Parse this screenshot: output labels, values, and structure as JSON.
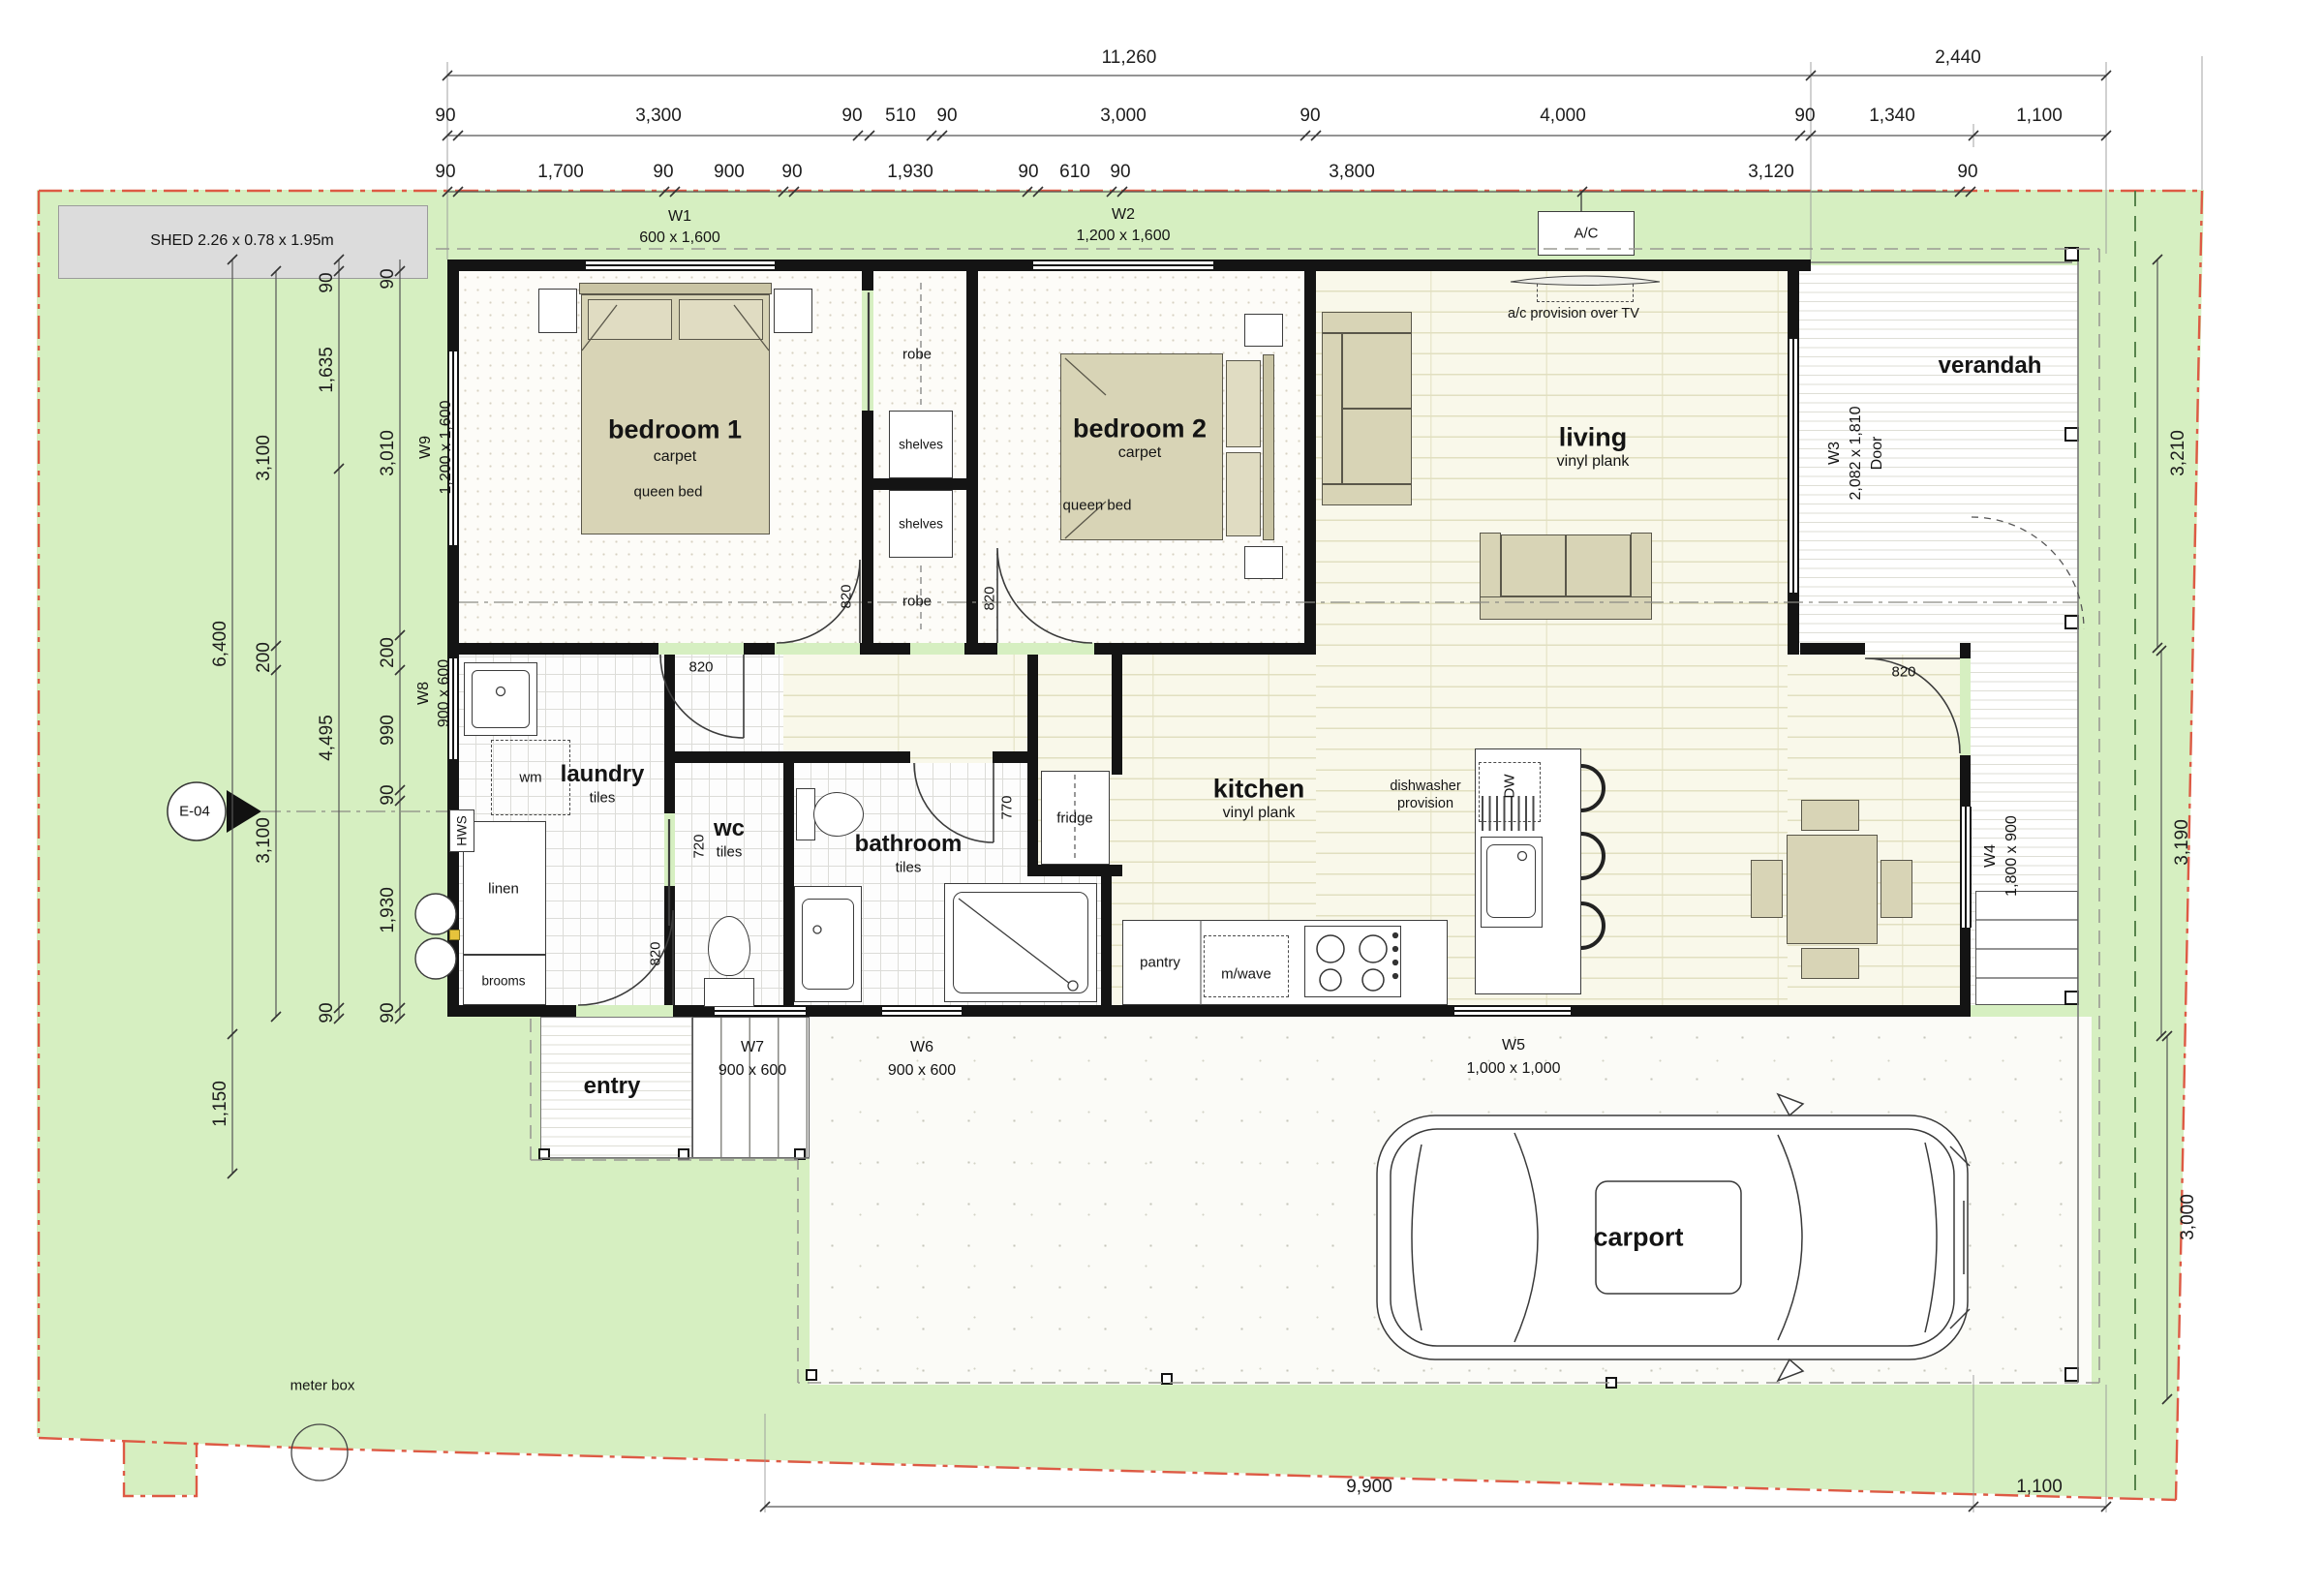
{
  "dims": {
    "rowA": [
      "11,260",
      "2,440"
    ],
    "rowB": [
      "90",
      "3,300",
      "90",
      "510",
      "90",
      "3,000",
      "90",
      "4,000",
      "90",
      "1,340",
      "1,100"
    ],
    "rowC": [
      "90",
      "1,700",
      "90",
      "900",
      "90",
      "1,930",
      "90",
      "610",
      "90",
      "3,800",
      "3,120",
      "90"
    ],
    "left1": [
      "6,400",
      "1,150"
    ],
    "left2": [
      "3,100",
      "200",
      "3,100"
    ],
    "left3": [
      "90",
      "1,635",
      "4,495",
      "90"
    ],
    "left4": [
      "90",
      "3,010",
      "200",
      "990",
      "90",
      "1,930",
      "90"
    ],
    "right": [
      "3,210",
      "3,190",
      "3,000"
    ],
    "bottom": [
      "9,900",
      "1,100"
    ]
  },
  "windows": {
    "w1": {
      "id": "W1",
      "size": "600 x 1,600"
    },
    "w2": {
      "id": "W2",
      "size": "1,200 x 1,600"
    },
    "w3": {
      "id": "W3",
      "size": "2,082 x 1,810",
      "type": "Door"
    },
    "w4": {
      "id": "W4",
      "size": "1,800 x 900"
    },
    "w5": {
      "id": "W5",
      "size": "1,000 x 1,000"
    },
    "w6": {
      "id": "W6",
      "size": "900 x 600"
    },
    "w7": {
      "id": "W7",
      "size": "900 x 600"
    },
    "w8": {
      "id": "W8",
      "size": "900 x 600"
    },
    "w9": {
      "id": "W9",
      "size": "1,200 x 1,600"
    }
  },
  "doors": {
    "standard": "820",
    "bath": "770",
    "wc": "720"
  },
  "rooms": {
    "bedroom1": {
      "name": "bedroom 1",
      "floor": "carpet",
      "furniture": "queen bed"
    },
    "bedroom2": {
      "name": "bedroom 2",
      "floor": "carpet",
      "furniture": "queen bed"
    },
    "living": {
      "name": "living",
      "floor": "vinyl plank"
    },
    "kitchen": {
      "name": "kitchen",
      "floor": "vinyl plank"
    },
    "laundry": {
      "name": "laundry",
      "floor": "tiles"
    },
    "wc": {
      "name": "wc",
      "floor": "tiles"
    },
    "bathroom": {
      "name": "bathroom",
      "floor": "tiles"
    },
    "verandah": {
      "name": "verandah"
    },
    "entry": {
      "name": "entry"
    },
    "carport": {
      "name": "carport"
    }
  },
  "fixtures": {
    "robe_upper": "robe",
    "robe_lower": "robe",
    "shelves_upper": "shelves",
    "shelves_lower": "shelves",
    "linen": "linen",
    "brooms": "brooms",
    "wm": "wm",
    "hws": "HWS",
    "fridge": "fridge",
    "pantry": "pantry",
    "microwave": "m/wave",
    "dw": "DW",
    "dw_provision": "dishwasher provision",
    "ac_unit": "A/C",
    "ac_provision": "a/c provision over TV"
  },
  "site": {
    "shed": "SHED 2.26 x 0.78 x 1.95m",
    "meter_box": "meter box",
    "section_marker": "E-04"
  }
}
